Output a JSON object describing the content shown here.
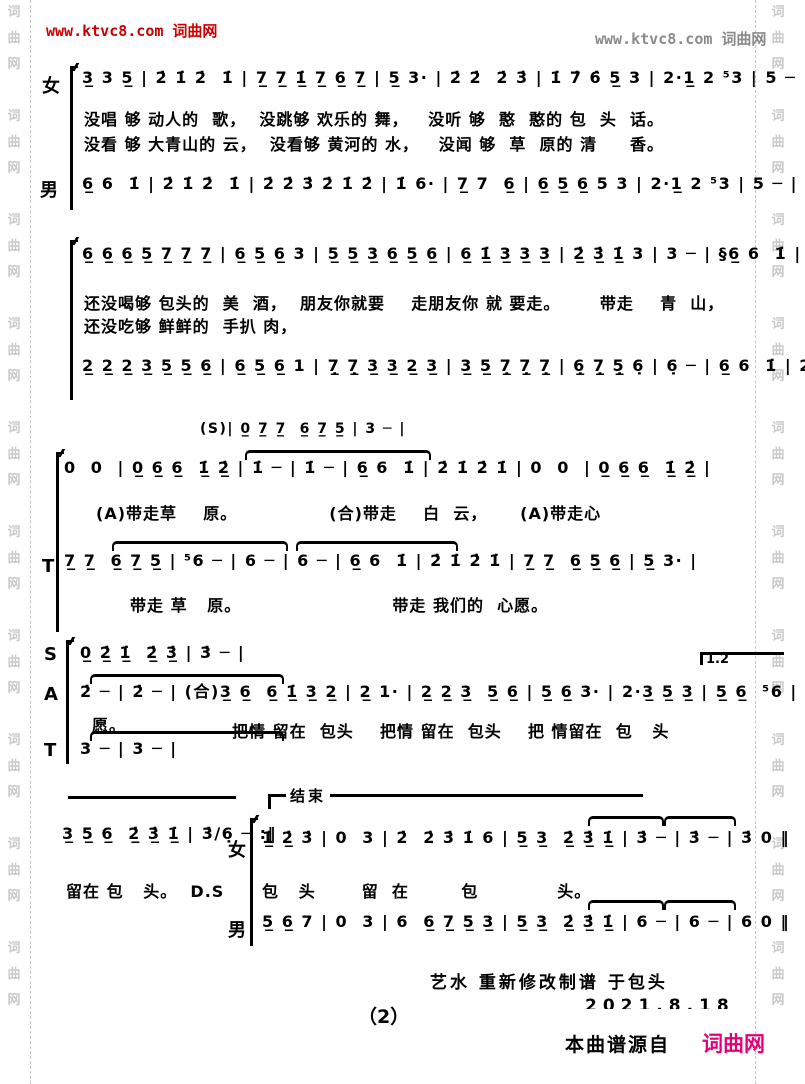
{
  "header": {
    "left": "www.ktvc8.com 词曲网",
    "right": "www.ktvc8.com 词曲网"
  },
  "watermark": {
    "column": "词\n曲\n网\n\n词\n曲\n网\n\n词\n曲\n网\n\n词\n曲\n网\n\n词\n曲\n网\n\n词\n曲\n网\n\n词\n曲\n网\n\n词\n曲\n网\n\n词\n曲\n网\n\n词\n曲\n网"
  },
  "score": {
    "sys1": {
      "label_female": "女",
      "label_male": "男",
      "female_notes": "3̲ 3 5̲ | 2̇ 1̇ 2̇  1̇ | 7̲ 7̲ 1̲̇ 7̲ 6̲ 7̲ | 5̲ 3· | 2̇ 2̇  2̇ 3̇ | 1̇ 7̇ 6̇ 5̲ 3 | 2·1̲ 2 ⁵3 | 5 ─ |",
      "lyric1": "没唱 够 动人的  歌，  没跳够 欢乐的 舞，   没听 够  憨  憨的 包  头  话。",
      "lyric2": "没看 够 大青山的 云，  没看够 黄河的 水，   没闻 够  草  原的 清     香。",
      "male_notes": "6̲ 6  1̇ | 2̇ 1̇ 2̇  1̇ | 2̇ 2̇ 3̇ 2̇ 1̇ 2̇ | 1̇ 6· | 7̲ 7  6̲ | 6̲ 5̲ 6̲ 5 3 | 2·1̲ 2 ⁵3 | 5 ─ |"
    },
    "sys2": {
      "upper_notes": "6̲ 6̲ 6̲ 5̲ 7̲ 7̲ 7̲ | 6̲ 5̲ 6̲ 3 | 5̲ 5̲ 3̲ 6̲ 5̲ 6̲ | 6̲ 1̲̇ 3̲ 3̲ 3̲ | 2̲̇ 3̲̇ 1̲̇ 3 | 3 ─ | §6̲ 6  1̇ | 2̇ 3̇ 2̇  1̇ |",
      "lyric1": "还没喝够 包头的  美  酒，  朋友你就要    走朋友你 就 要走。      带走    青  山，",
      "lyric2": "还没吃够 鲜鲜的  手扒 肉，",
      "lower_notes": "2̲ 2̲ 2̲ 3̲ 5̲ 5̲ 6̲ | 6̲ 5̲ 6̲ 1 | 7̣̲ 7̣̲ 3̲ 3̲ 2̲ 3̲ | 3̲ 5̲ 7̣̲ 7̣̲ 7̣̲ | 6̣̲ 7̣̲ 5̣̲ 6̣ | 6̣ ─ | 6̲ 6  1̇ | 2̇ 3̇ 2̇  1̇ |"
    },
    "sys3": {
      "s_line": "(S)| 0̲ 7̲ 7̲  6̲ 7̲ 5̲ | 3 ─ |",
      "main_notes": "0  0  | 0̲ 6̲ 6̲  1̲̇ 2̲̇ | 1̇ ─ | 1̇ ─ | 6̲ 6  1̇ | 2̇ 1̇ 2̇ 1̇ | 0  0  | 0̲ 6̲ 6̲  1̲̇ 2̲̇ |",
      "lyric": "(A)带走草    原。              (合)带走    白  云，     (A)带走心"
    },
    "sys4": {
      "label": "T",
      "notes": "7̲ 7̲  6̲ 7̲ 5̲ | ⁵6 ─ | 6 ─ | 6 ─ | 6̲ 6  1̇ | 2̇ 1̇ 2̇ 1̇ | 7̲ 7̲  6̲ 5̲ 6̲ | 5̲ 3· |",
      "lyric": "带走 草   原。                       带走 我们的  心愿。"
    },
    "sys5": {
      "label_s": "S",
      "label_a": "A",
      "label_t": "T",
      "s_notes": "0̲ 2̲̇ 1̲̇  2̲̇ 3̲̇ | 3̇ ─ |",
      "a_notes": "2̇ ─ | 2̇ ─ | (合)3̲ 6̲  6̲ 1̲̇ 3̲ 2̲ | 2̲ 1· | 2̲ 2̲ 3̲  5̲ 6̲ | 5̲ 6̲ 3· | 2·3̲ 5̲ 3̲ | 5̲ 6̲  ⁵6 |",
      "t_notes": "3 ─ | 3 ─ |",
      "volta": "1.2",
      "lyric_wish": "愿。",
      "lyric": "把情 留在  包头    把情 留在  包头    把 情留在  包   头"
    },
    "sys6": {
      "coda_notes": "3̲ 5̲ 6̲  2̲̇ 3̲̇ 1̲̇ | 3̇∕6̣ ─ :‖",
      "coda_lyric": "留在 包   头。  D.S",
      "end_label": "结束",
      "label_female": "女",
      "label_male": "男",
      "female_notes": "1̲̇ 2̲̇ 3̇ | 0  3 | 2̇  2̇ 3̇ 1̇ 6 | 5̲ 3̲  2̲̇ 3̲̇ 1̲̇ | 3̇ ─ | 3̇ ─ | 3̇ 0 ‖",
      "lyric": "包   头       留  在        包            头。",
      "male_notes": "5̲ 6̲ 7 | 0  3 | 6  6̲ 7̲ 5̲ 3̲ | 5̲ 3̲  2̲̇ 3̲̇ 1̲̇ | 6 ─ | 6 ─ | 6 0 ‖"
    }
  },
  "footer": {
    "credit": "艺水 重新修改制谱 于包头",
    "date": "2021.8.18",
    "page_number": "（2）",
    "source_label": "本曲谱源自",
    "brand": "词曲网"
  }
}
